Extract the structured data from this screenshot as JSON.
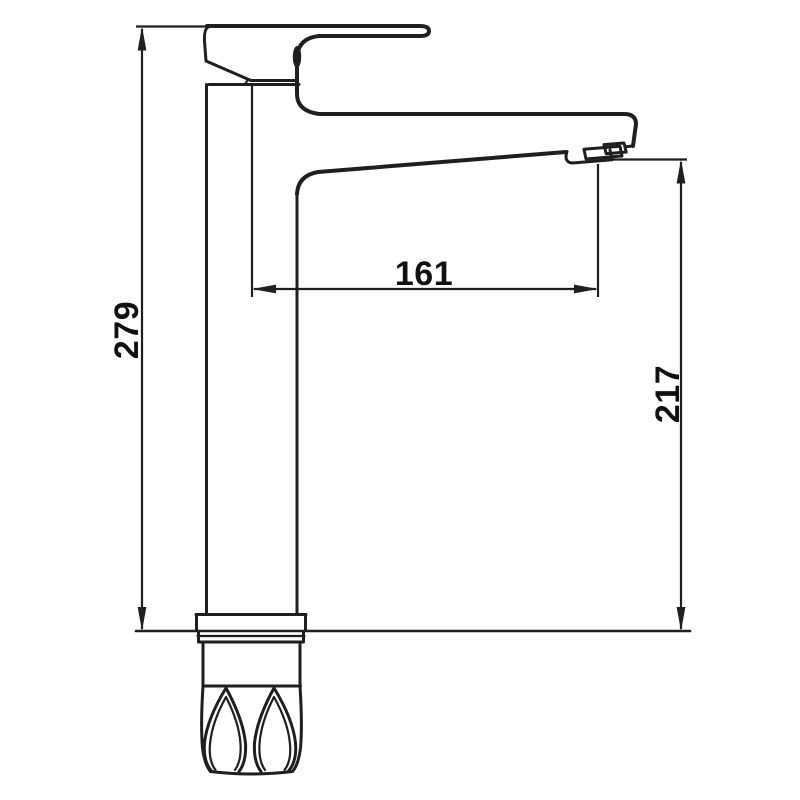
{
  "drawing": {
    "kind": "technical-dimension-drawing",
    "subject": "tall single-lever basin mixer faucet, side elevation",
    "line_color": "#1f1f1f",
    "text_color": "#111111",
    "background": "#ffffff",
    "dimensions": [
      {
        "id": "overall-height",
        "value": "279",
        "orientation": "vertical",
        "position": "left"
      },
      {
        "id": "spout-reach",
        "value": "161",
        "orientation": "horizontal",
        "position": "center"
      },
      {
        "id": "spout-outlet-height",
        "value": "217",
        "orientation": "vertical",
        "position": "right"
      }
    ]
  }
}
